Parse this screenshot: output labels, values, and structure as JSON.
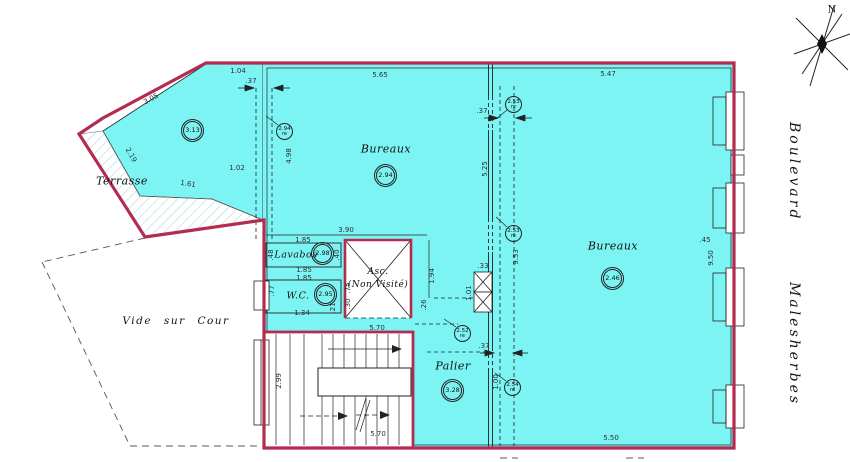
{
  "colors": {
    "floor": "#7df4f4",
    "wall": "#b32c50",
    "hatch": "#a9dcdc"
  },
  "compass": {
    "n": "N"
  },
  "street": {
    "w1": "Boulevard",
    "w2": "Malesherbes"
  },
  "rooms": {
    "terrasse": {
      "label": "Terrasse"
    },
    "bureaux_center": {
      "label": "Bureaux"
    },
    "bureaux_right": {
      "label": "Bureaux"
    },
    "lavabos": {
      "label": "Lavabos"
    },
    "wc": {
      "label": "W.C."
    },
    "asc": {
      "line1": "Asc.",
      "line2": "(Non Visité)"
    },
    "palier": {
      "label": "Palier"
    },
    "vide": {
      "label": "Vide sur Cour"
    }
  },
  "badges": {
    "tl": "3.13",
    "center": "2.94",
    "right": "2.46",
    "lavabos": "2.98",
    "wc": "2.95",
    "palier": "3.28"
  },
  "re_badges": {
    "r1": {
      "v": "2.94",
      "s": "re"
    },
    "r2": {
      "v": "2.53",
      "s": "re"
    },
    "r3": {
      "v": "2.53",
      "s": "re"
    },
    "r4": {
      "v": "2.52",
      "s": "re"
    },
    "r5": {
      "v": "2.54",
      "s": "re"
    }
  },
  "dims": {
    "d1": "1.04",
    "d2": ".37",
    "d3": "3.05",
    "d4": "2.19",
    "d5": "1.61",
    "d6": "1.02",
    "d7": "5.65",
    "d8": "4.98",
    "d9": "3.90",
    "d10": "5.47",
    "d11": ".37",
    "d12": "5.25",
    "d13": "9.53",
    "d14": ".33",
    "d15": "1.01",
    "d16": "1.94",
    "d17": ".26",
    "d18": "1.85",
    "d19": ".48",
    "d20": ".40",
    "d21": "1.85",
    "d22": "1.85",
    "d23": ".77",
    "d24": "1.34",
    "d25": ".21",
    "d26": ".75",
    "d27": ".30",
    "d28": "5.70",
    "d29": "5.70",
    "d30": "2.99",
    "d31": ".37",
    "d32": "1.00",
    "d33": "5.50",
    "d34": ".45",
    "d35": "9.50"
  }
}
